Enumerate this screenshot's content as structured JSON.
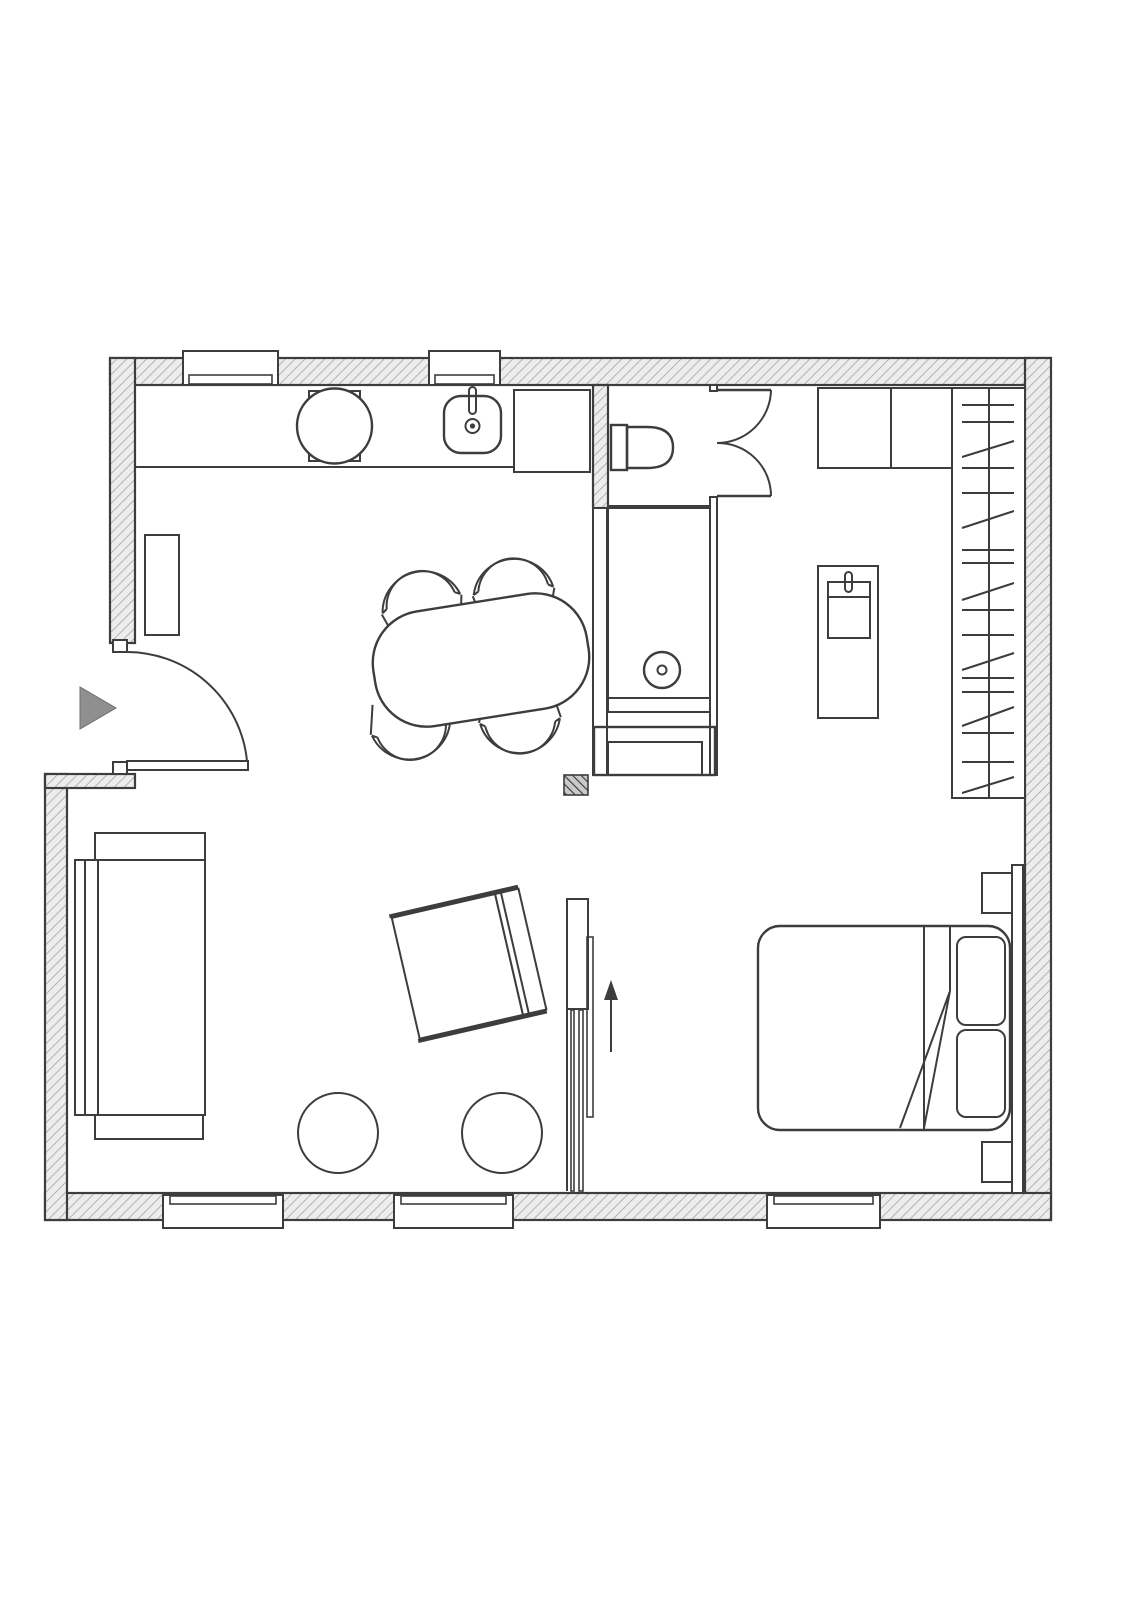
{
  "document": {
    "kind": "floor-plan",
    "description": "Black-and-white architectural floor plan of a studio apartment, top-down view, hatched walls, no text labels",
    "visible_text": []
  },
  "colors": {
    "background": "#ffffff",
    "line": "#3d3d3d",
    "wall_fill": "#ededed",
    "wall_hatch": "#a8a8a8",
    "column_fill": "#c9c9c9",
    "column_hatch": "#3f3f3f",
    "entry_arrow": "#8f8f8f"
  },
  "symbols": {
    "windows": 5,
    "doors": [
      "entry-swing-door",
      "bathroom-double-swing-door"
    ],
    "kitchen": [
      "kitchen-counter",
      "round-appliance",
      "kitchen-sink-with-faucet",
      "tall-appliance",
      "tall-cabinet"
    ],
    "bathroom": [
      "toilet",
      "shower-with-drain",
      "bathroom-cabinet",
      "service-column"
    ],
    "dressing": [
      "wardrobe-with-rail",
      "upper-cabinet",
      "upper-cabinet",
      "washbasin-console"
    ],
    "dining": [
      "oval-dining-table",
      "dining-chair",
      "dining-chair",
      "dining-chair",
      "dining-chair"
    ],
    "living": [
      "sofa",
      "armchair",
      "pouf",
      "pouf",
      "sliding-room-divider",
      "direction-arrow",
      "entrance-arrow"
    ],
    "bedroom": [
      "double-bed",
      "pillow",
      "pillow",
      "headboard-panel",
      "nightstand",
      "nightstand"
    ]
  }
}
